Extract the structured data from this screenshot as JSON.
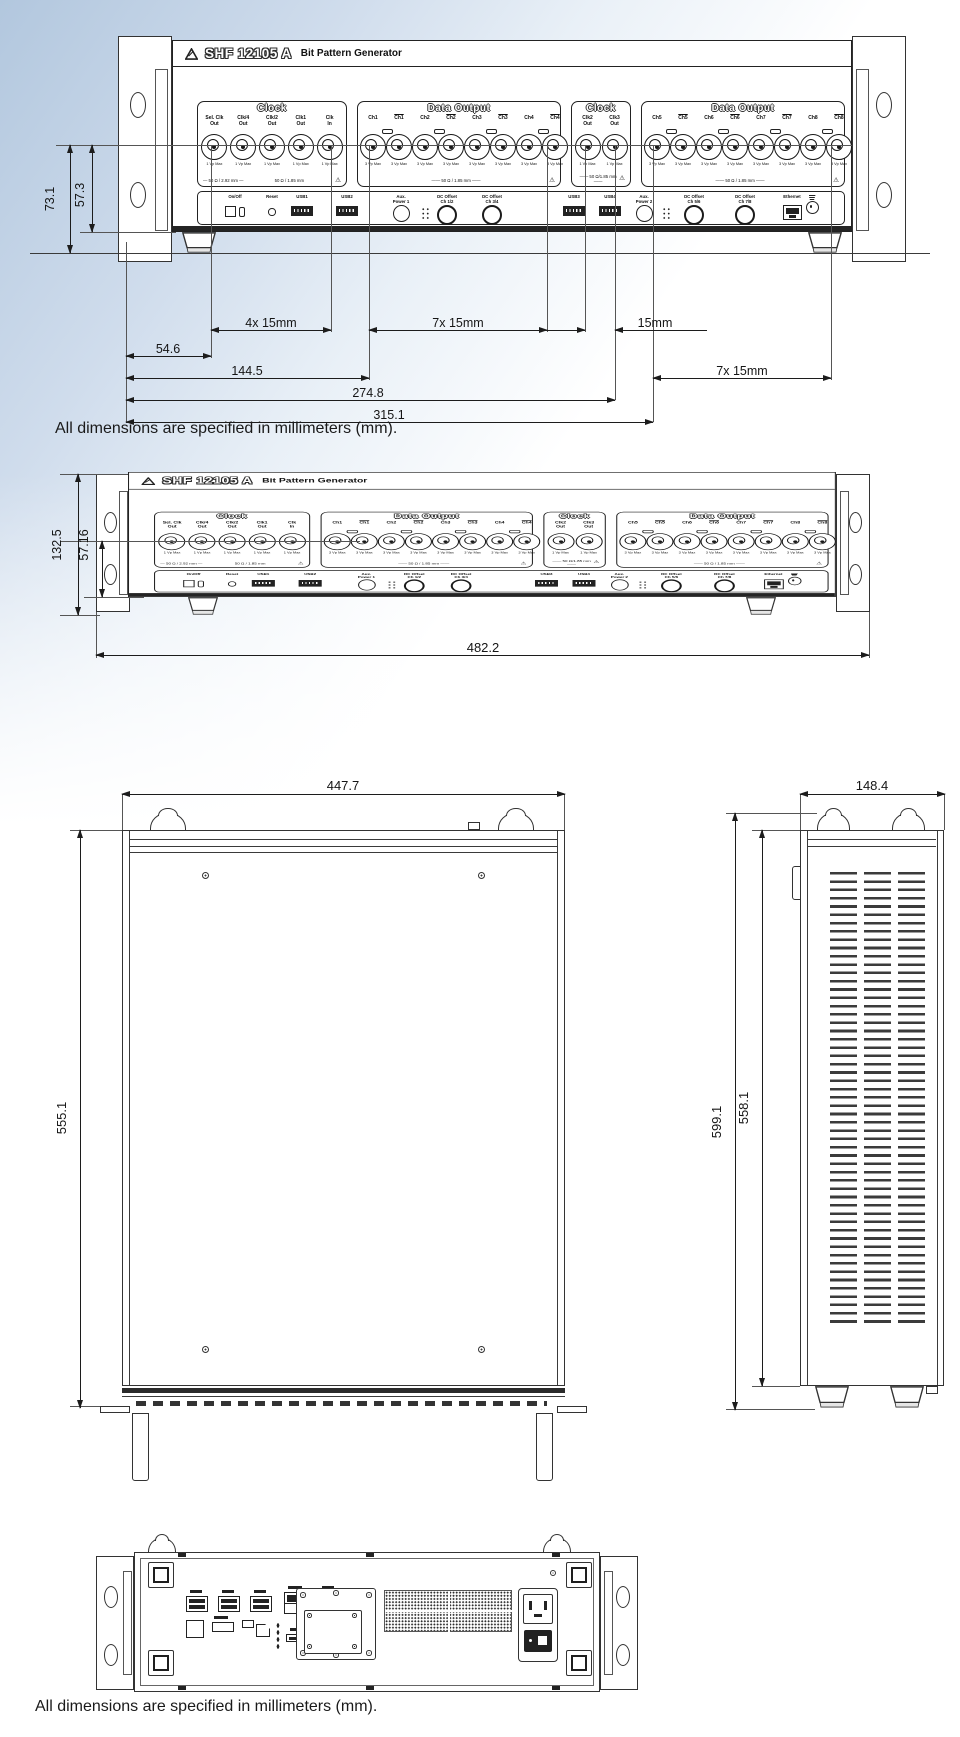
{
  "notes": {
    "units_note": "All dimensions are specified in millimeters (mm)."
  },
  "device": {
    "brand": "SHF 12105 A",
    "product": "Bit Pattern Generator"
  },
  "front_panel": {
    "sections": [
      {
        "kind": "clock",
        "title": "Clock",
        "ports": [
          [
            "Sel. Clk",
            "Out"
          ],
          [
            "Clk/4",
            "Out"
          ],
          [
            "Clk/2",
            "Out"
          ],
          [
            "Clk1",
            "Out"
          ],
          [
            "Clk",
            "In"
          ]
        ],
        "port_note": "1 Vp Max",
        "footer_left": "50 Ω / 2.92 mm",
        "footer_right": "50 Ω / 1.85 mm",
        "warning": true
      },
      {
        "kind": "data",
        "title": "Data Output",
        "ports": [
          [
            "Ch1"
          ],
          [
            "Ch1"
          ],
          [
            "Ch2"
          ],
          [
            "Ch2"
          ],
          [
            "Ch3"
          ],
          [
            "Ch3"
          ],
          [
            "Ch4"
          ],
          [
            "Ch4"
          ]
        ],
        "port_note": "3 Vp Max",
        "footer_center": "50 Ω / 1.85 mm",
        "warning": true
      },
      {
        "kind": "clock",
        "title": "Clock",
        "ports": [
          [
            "Clk2",
            "Out"
          ],
          [
            "Clk3",
            "Out"
          ]
        ],
        "port_note": "1 Vp Max",
        "footer_center": "50 Ω/1.85 mm",
        "warning": true
      },
      {
        "kind": "data",
        "title": "Data Output",
        "ports": [
          [
            "Ch5"
          ],
          [
            "Ch5"
          ],
          [
            "Ch6"
          ],
          [
            "Ch6"
          ],
          [
            "Ch7"
          ],
          [
            "Ch7"
          ],
          [
            "Ch8"
          ],
          [
            "Ch8"
          ]
        ],
        "port_note": "3 Vp Max",
        "footer_center": "50 Ω / 1.85 mm",
        "warning": true
      }
    ],
    "controls": [
      {
        "type": "power",
        "label": "On/Off"
      },
      {
        "type": "reset",
        "label": "Reset"
      },
      {
        "type": "usb",
        "label": "USB1"
      },
      {
        "type": "usb",
        "label": "USB2"
      },
      {
        "type": "jack",
        "label": "Aux.\nPower 1"
      },
      {
        "type": "pins",
        "label": ""
      },
      {
        "type": "dc",
        "label": "DC Offset\nCh 1/2"
      },
      {
        "type": "dc",
        "label": "DC Offset\nCh 3/4"
      },
      {
        "type": "usb",
        "label": "USB3"
      },
      {
        "type": "usb",
        "label": "USB4"
      },
      {
        "type": "jack",
        "label": "Aux.\nPower 2"
      },
      {
        "type": "pins",
        "label": ""
      },
      {
        "type": "dc",
        "label": "DC Offset\nCh 5/6"
      },
      {
        "type": "dc",
        "label": "DC Offset\nCh 7/8"
      },
      {
        "type": "eth",
        "label": "Ethernet"
      },
      {
        "type": "gnd",
        "label": ""
      }
    ]
  },
  "dimensions": {
    "front": {
      "height_overall": "73.1",
      "height_connector": "57.3",
      "left_offset": "54.6",
      "clock_pitch": "4x 15mm",
      "data1_pitch": "7x 15mm",
      "clock2_pitch": "15mm",
      "to_data1": "144.5",
      "data2_pitch": "7x 15mm",
      "to_clock2": "274.8",
      "to_data2": "315.1"
    },
    "mounted": {
      "height": "132.5",
      "connector_height": "57.16",
      "width": "482.2"
    },
    "top": {
      "width": "447.7",
      "depth": "555.1"
    },
    "side": {
      "width": "148.4",
      "depth_overall": "599.1",
      "depth_body": "558.1"
    }
  }
}
